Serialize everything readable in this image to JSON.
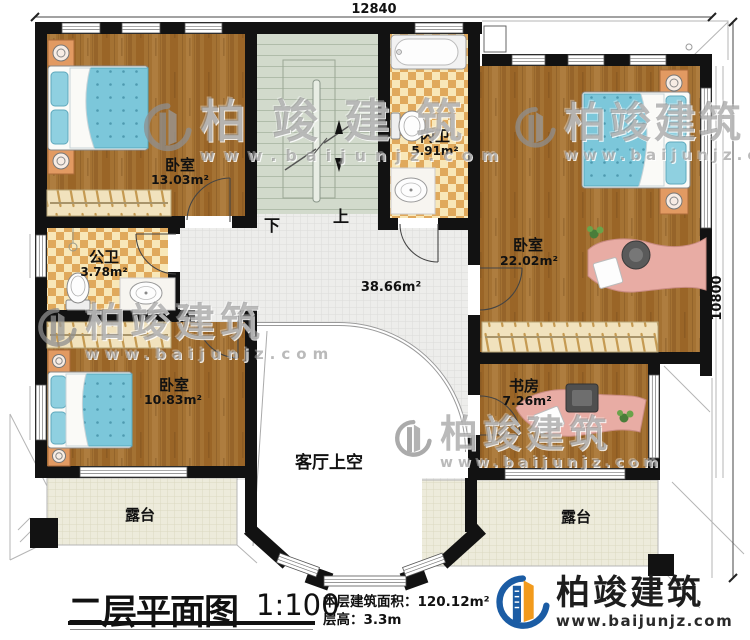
{
  "dimensions": {
    "width_mm": "12840",
    "height_mm": "10800"
  },
  "rooms": {
    "bedroom_tl": {
      "name": "卧室",
      "area": "13.03m²"
    },
    "inner_bath": {
      "name": "内卫",
      "area": "5.91m²"
    },
    "bedroom_r": {
      "name": "卧室",
      "area": "22.02m²"
    },
    "public_bath": {
      "name": "公卫",
      "area": "3.78m²"
    },
    "hallway": {
      "area": "38.66m²"
    },
    "bedroom_bl": {
      "name": "卧室",
      "area": "10.83m²"
    },
    "study": {
      "name": "书房",
      "area": "7.26m²"
    },
    "living_void": {
      "name": "客厅上空"
    },
    "terrace_left": {
      "name": "露台"
    },
    "terrace_right": {
      "name": "露台"
    }
  },
  "stairs": {
    "down_label": "下",
    "up_label": "上"
  },
  "title_block": {
    "title": "二层平面图",
    "scale": "1:100",
    "area_label": "本层建筑面积：",
    "area_value": "120.12m²",
    "height_label": "层高：",
    "height_value": "3.3m"
  },
  "brand": {
    "name": "柏竣建筑",
    "url": "www.baijunjz.com"
  },
  "colors": {
    "wall": "#121212",
    "wood": "#a2702f",
    "tile_light": "#f8e7b8",
    "tile_dark": "#e0a95c",
    "stair": "#d2dacc",
    "accent_blue": "#1b5ca4",
    "accent_orange": "#f29a1c"
  }
}
